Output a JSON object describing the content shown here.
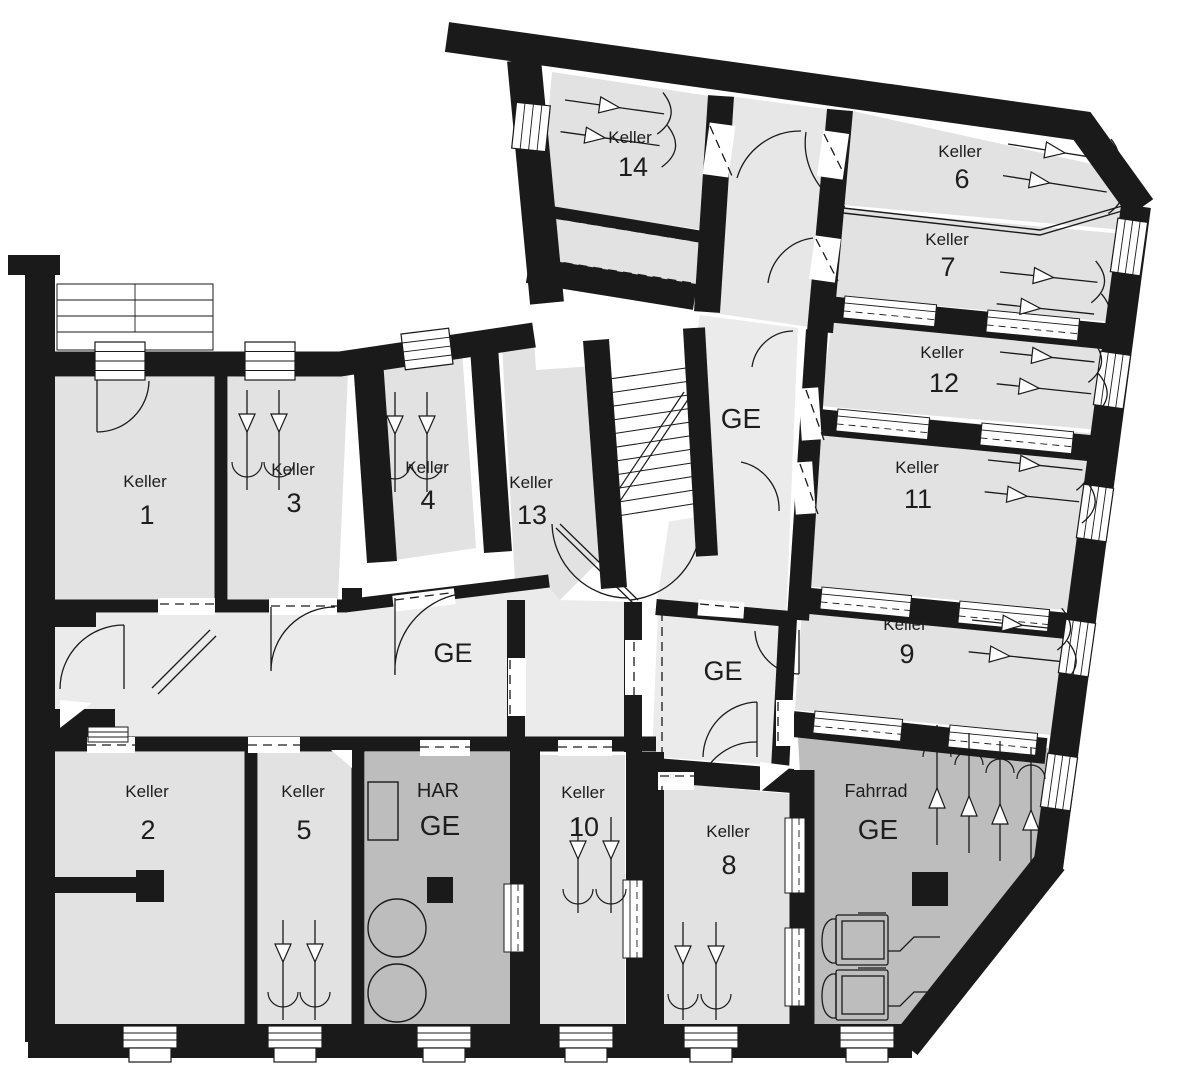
{
  "title": "Kellergeschoss Grundriss",
  "colors": {
    "wall": "#1a1a1a",
    "room": "#e2e2e2",
    "corridor": "#ebebeb",
    "utility": "#bdbdbd",
    "background": "#ffffff"
  },
  "rooms": [
    {
      "id": "keller-1",
      "label": "Keller",
      "number": "1"
    },
    {
      "id": "keller-2",
      "label": "Keller",
      "number": "2"
    },
    {
      "id": "keller-3",
      "label": "Keller",
      "number": "3"
    },
    {
      "id": "keller-4",
      "label": "Keller",
      "number": "4"
    },
    {
      "id": "keller-5",
      "label": "Keller",
      "number": "5"
    },
    {
      "id": "keller-6",
      "label": "Keller",
      "number": "6"
    },
    {
      "id": "keller-7",
      "label": "Keller",
      "number": "7"
    },
    {
      "id": "keller-8",
      "label": "Keller",
      "number": "8"
    },
    {
      "id": "keller-9",
      "label": "Keller",
      "number": "9"
    },
    {
      "id": "keller-10",
      "label": "Keller",
      "number": "10"
    },
    {
      "id": "keller-11",
      "label": "Keller",
      "number": "11"
    },
    {
      "id": "keller-12",
      "label": "Keller",
      "number": "12"
    },
    {
      "id": "keller-13",
      "label": "Keller",
      "number": "13"
    },
    {
      "id": "keller-14",
      "label": "Keller",
      "number": "14"
    }
  ],
  "areas": {
    "ge_main": "GE",
    "ge_corridor": "GE",
    "ge_vestibule": "GE",
    "har": {
      "label": "HAR",
      "sublabel": "GE"
    },
    "fahrrad": {
      "label": "Fahrrad",
      "sublabel": "GE"
    }
  }
}
